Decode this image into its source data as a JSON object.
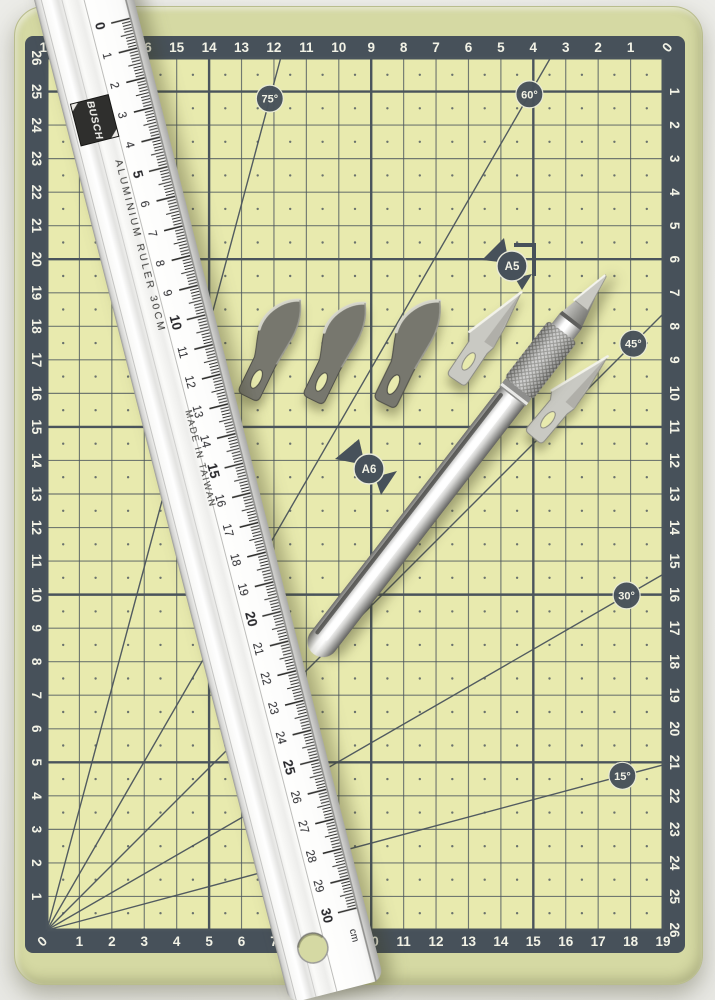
{
  "mat": {
    "columns": 19,
    "rows": 26,
    "top_edge_numbers": [
      "19",
      "18",
      "17",
      "16",
      "15",
      "14",
      "13",
      "12",
      "11",
      "10",
      "9",
      "8",
      "7",
      "6",
      "5",
      "4",
      "3",
      "2",
      "1",
      "0"
    ],
    "bottom_edge_numbers": [
      "0",
      "1",
      "2",
      "3",
      "4",
      "5",
      "6",
      "7",
      "8",
      "9",
      "10",
      "11",
      "12",
      "13",
      "14",
      "15",
      "16",
      "17",
      "18",
      "19"
    ],
    "left_edge_numbers": [
      "26",
      "25",
      "24",
      "23",
      "22",
      "21",
      "20",
      "19",
      "18",
      "17",
      "16",
      "15",
      "14",
      "13",
      "12",
      "11",
      "10",
      "9",
      "8",
      "7",
      "6",
      "5",
      "4",
      "3",
      "2",
      "1"
    ],
    "right_edge_numbers": [
      "1",
      "2",
      "3",
      "4",
      "5",
      "6",
      "7",
      "8",
      "9",
      "10",
      "11",
      "12",
      "13",
      "14",
      "15",
      "16",
      "17",
      "18",
      "19",
      "20",
      "21",
      "22",
      "23",
      "24",
      "25",
      "26"
    ],
    "angle_markers": [
      {
        "angle": 75,
        "label": "75°"
      },
      {
        "angle": 60,
        "label": "60°"
      },
      {
        "angle": 45,
        "label": "45°"
      },
      {
        "angle": 30,
        "label": "30°"
      },
      {
        "angle": 15,
        "label": "15°"
      }
    ],
    "size_markers": [
      {
        "label": "A5"
      },
      {
        "label": "A6"
      }
    ]
  },
  "ruler": {
    "brand": "BUSCH",
    "spec_text": "ALUMINIUM RULER  30CM",
    "made_in_text": "MADE IN TAIWAN",
    "unit_label": "cm",
    "cm_numbers": [
      0,
      1,
      2,
      3,
      4,
      5,
      6,
      7,
      8,
      9,
      10,
      11,
      12,
      13,
      14,
      15,
      16,
      17,
      18,
      19,
      20,
      21,
      22,
      23,
      24,
      25,
      26,
      27,
      28,
      29,
      30
    ]
  },
  "tools": {
    "knife": "hobby-knife",
    "curved_blade_count": 3,
    "straight_blade_count": 2
  },
  "colors": {
    "mat_margin": "#d5d9a3",
    "mat_cell": "#e8eaae",
    "mat_band": "#47515a",
    "grid_line": "#4a545c",
    "edge_number": "#f2f2e6",
    "ruler_tick": "#2e2e2c",
    "ruler_brand_bg": "#2f2f2d",
    "blade_dark": "#77776e",
    "blade_silver": "#c9c9c3"
  }
}
